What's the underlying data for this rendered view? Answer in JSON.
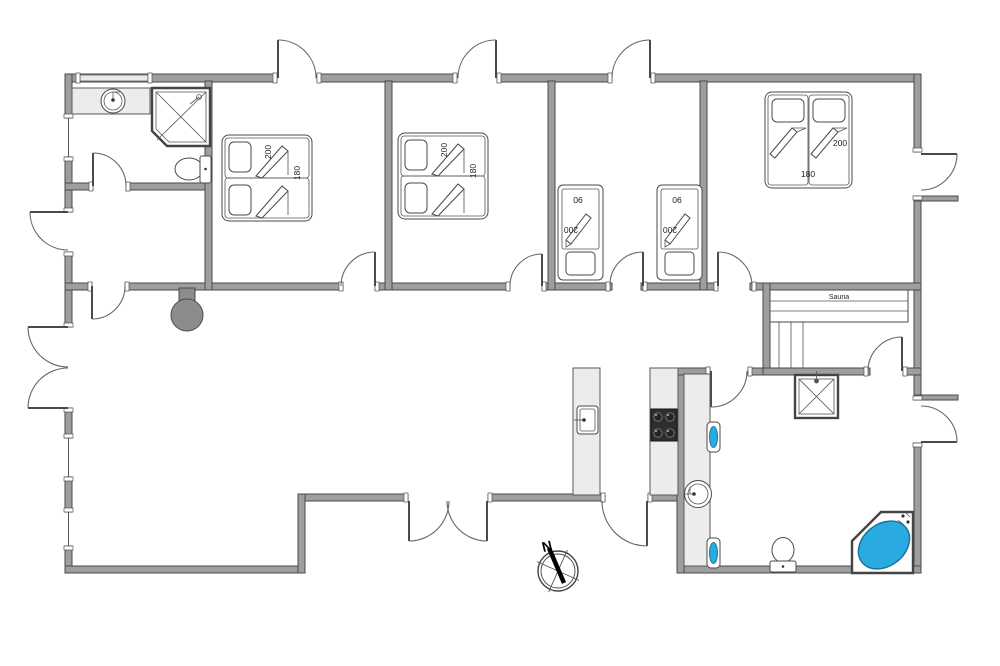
{
  "plan": {
    "sauna_label": "Sauna",
    "compass_north": "N",
    "beds": {
      "bedroom1": {
        "length": "200",
        "width": "180"
      },
      "bedroom2": {
        "length": "200",
        "width": "180"
      },
      "master": {
        "length": "200",
        "width": "180"
      },
      "single1": {
        "width": "90",
        "length": "200"
      },
      "single2": {
        "width": "90",
        "length": "200"
      }
    }
  },
  "colors": {
    "wall_gray": "#9e9e9e",
    "wall_outline": "#4a4a4a",
    "counter_gray": "#ececec",
    "fixture_blue": "#29abe2",
    "stove_black": "#2e2e2e",
    "wood_stove_gray": "#8c8c8c"
  }
}
